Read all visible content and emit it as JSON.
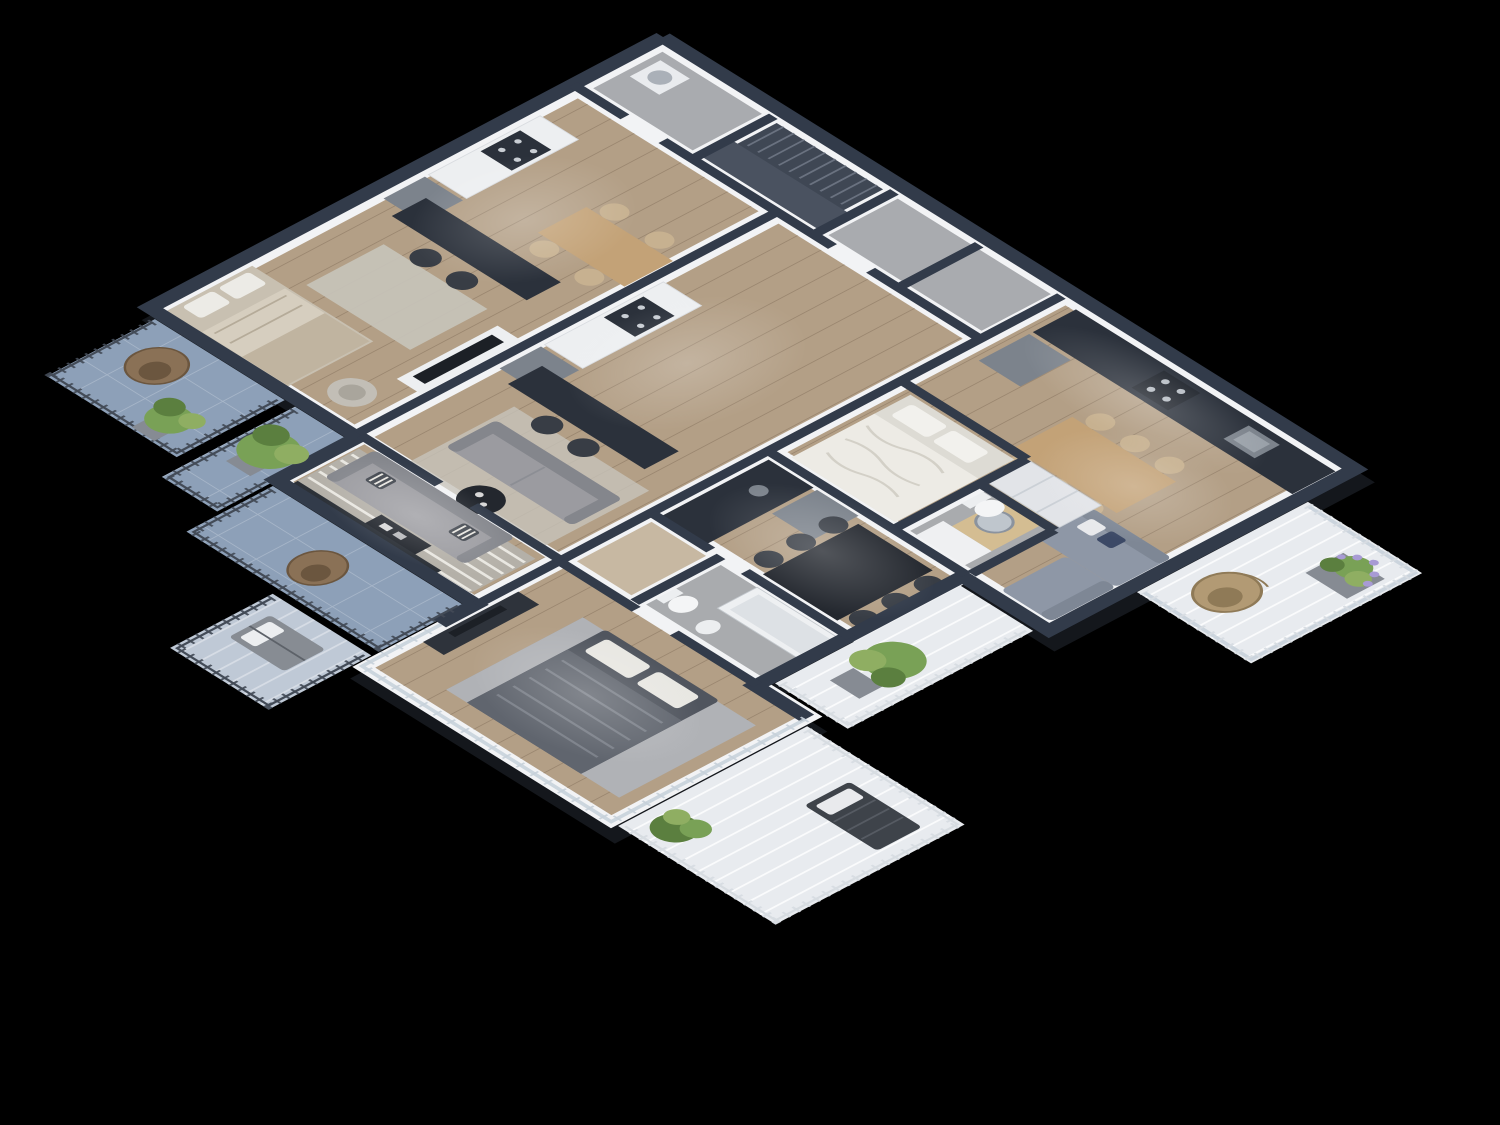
{
  "scene": {
    "title": "3D cutaway floor plan render of an apartment storey, top-down axonometric view on a black background",
    "type": "architectural-visualization-render",
    "visible_text": "none"
  },
  "palette": {
    "bg": "#000000",
    "shadow": "#14171c",
    "wallCap": "#323b4a",
    "wallFace": "#f2f3f5",
    "slabBase": "#e7e8ea",
    "floorWood": "#b39f86",
    "floorWoodLight": "#c7b8a2",
    "corridorConcrete": "#a9abaf",
    "bathFloor": "#a9abae",
    "balconyBlue": "#8da0b8",
    "balconyLightBlue": "#bfc9d6",
    "deckWhite": "#e8ebef",
    "counterDark": "#2b313b",
    "steel": "#7c838c",
    "cabinetWhite": "#edeff1",
    "tableDark": "#23272e",
    "woodWarm": "#c3a277",
    "woodLight": "#d4bd92",
    "chairTan": "#c7b190",
    "chairDark": "#383d45",
    "sofaGrey": "#9b9ba0",
    "sofaGreyDark": "#84868c",
    "sofaBlue": "#8e97a6",
    "pillowNavy": "#3c4966",
    "bedBeige": "#d6cebf",
    "bedBlanket": "#c0b4a0",
    "bedWhite": "#edebe5",
    "bedDark": "#50555e",
    "duvetDark": "#60656e",
    "rugLight": "#c7c3ba",
    "rugStripeBase": "#b4b0a8",
    "rugGrey": "#b0b2b6",
    "plantGreen": "#79a156",
    "plantMid": "#8fae62",
    "plantDark": "#5b7f3f",
    "lavender": "#a89bd4",
    "potGrey": "#868b93",
    "eggChair": "#8a7156",
    "eggChairDark": "#6b563f",
    "eggChairLight": "#b29a74",
    "railDark": "#434b57",
    "railLight": "#d7dce1",
    "glass": "#c6d0d9",
    "stairFloor": "#3f4754",
    "stairLanding": "#4a5260",
    "stairStep": "#6a7280",
    "tvDark": "#1c2026",
    "white": "#f4f5f6"
  },
  "building": {
    "storey": "single residential floor, cutaway (no ceiling)",
    "apartments": [
      {
        "id": "top-left-strip",
        "rooms": [
          "kitchen",
          "dining-area",
          "tv-living-area",
          "bedroom"
        ],
        "furniture": [
          "white-kitchen-cabinets",
          "gas-stove",
          "steel-fridge",
          "dark-bar-counter-two-chairs",
          "wood-dining-table-four-chairs",
          "tv-on-white-console",
          "area-rug",
          "beige-double-bed",
          "armchair"
        ]
      },
      {
        "id": "middle-strip",
        "rooms": [
          "kitchen",
          "living-area"
        ],
        "furniture": [
          "white-kitchen-cabinets",
          "gas-stove",
          "steel-fridge",
          "dark-bar-counter-two-stools",
          "grey-two-seat-sofa",
          "round-dark-coffee-table",
          "area-rug"
        ]
      },
      {
        "id": "center-south",
        "rooms": [
          "kitchen",
          "dining-area",
          "living-area",
          "bathroom",
          "bedroom"
        ],
        "furniture": [
          "dark-kitchen-counter",
          "steel-fridge",
          "long-dark-dining-table-six-chairs",
          "grey-sofa-striped-pillows",
          "striped-area-rug",
          "dark-coffee-table",
          "media-bench",
          "bathtub",
          "toilet",
          "bidet",
          "dark-double-bed",
          "tv-dresser",
          "glass-walls-to-terrace"
        ]
      },
      {
        "id": "right",
        "rooms": [
          "kitchen",
          "dining-area",
          "living-area",
          "bathroom",
          "bedroom"
        ],
        "furniture": [
          "dark-kitchen-counter-with-sink",
          "gas-stove",
          "steel-fridge",
          "light-wood-dining-table-six-chairs",
          "l-shaped-corner-sofa",
          "checkered-navy-pillow",
          "wood-coffee-table",
          "round-mirror",
          "white-vanity",
          "toilet",
          "white-double-bed",
          "wardrobe"
        ]
      }
    ],
    "core": {
      "elements": [
        "staircase",
        "stair-landing",
        "entry-corridor",
        "storage-closets",
        "utility-room-washer"
      ]
    },
    "balconies": [
      {
        "id": "west-upper",
        "deck": "blue-concrete",
        "items": [
          "cocoon-chair",
          "potted-plant"
        ]
      },
      {
        "id": "west-middle",
        "deck": "blue-concrete",
        "items": [
          "large-potted-plant"
        ]
      },
      {
        "id": "west-lower-terrace",
        "deck": "blue-concrete",
        "items": [
          "cocoon-chair"
        ]
      },
      {
        "id": "south-west-small",
        "deck": "light-concrete",
        "items": [
          "outdoor-lounge-chair"
        ]
      },
      {
        "id": "south-terrace",
        "deck": "white-decking",
        "items": [
          "sun-lounger",
          "green-shrub"
        ]
      },
      {
        "id": "east",
        "deck": "white-decking",
        "items": [
          "hanging-egg-chair",
          "planter-with-lavender"
        ],
        "balustrade": "glass"
      },
      {
        "id": "south-east",
        "deck": "white-decking",
        "items": [
          "potted-bamboo-plant"
        ]
      }
    ],
    "lighting": "interior ceiling spots glowing on floors, pure black exterior"
  }
}
